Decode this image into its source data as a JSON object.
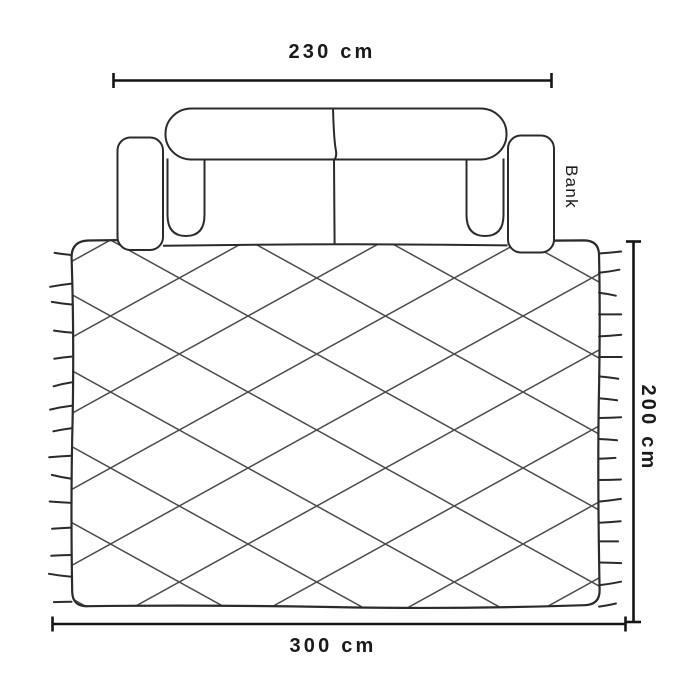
{
  "diagram": {
    "title": "sofa-rug-top-view-dimension-diagram",
    "labels": {
      "sofa": "Bank",
      "sofa_width": "230 cm",
      "rug_width": "300 cm",
      "rug_depth": "200 cm"
    },
    "colors": {
      "background": "#ffffff",
      "outline": "#2b2b2b",
      "lattice": "#4c4c4c",
      "dimension": "#151515",
      "text": "#1a1a1a"
    }
  }
}
